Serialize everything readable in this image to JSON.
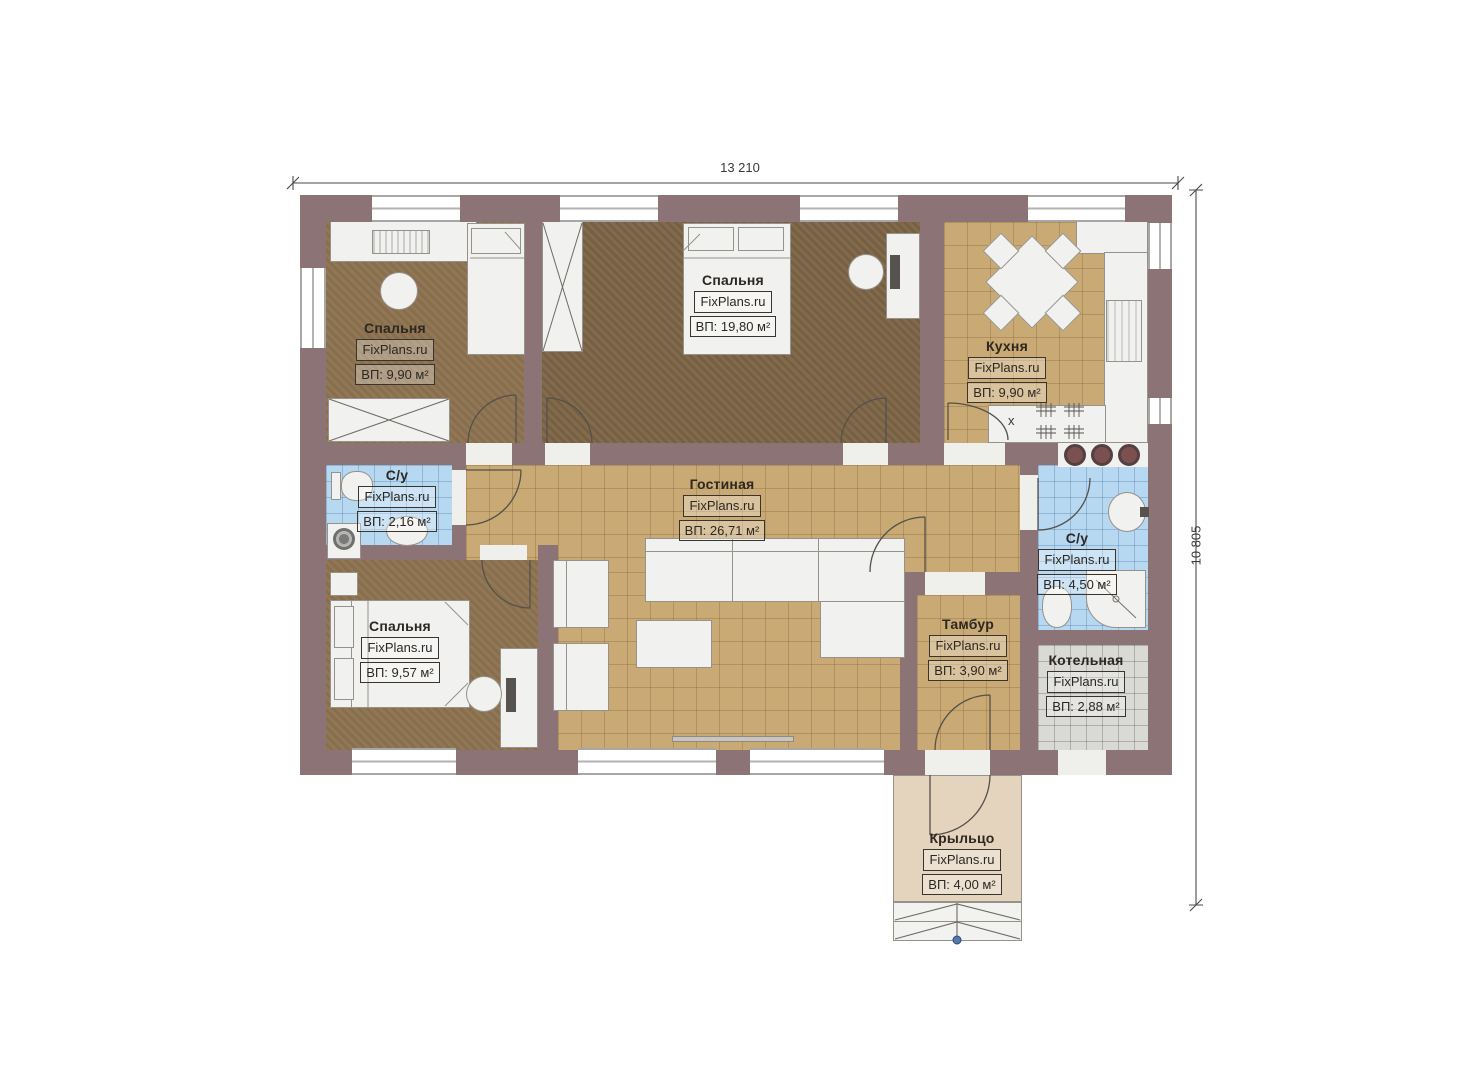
{
  "dimensions": {
    "width_label": "13 210",
    "height_label": "10 805"
  },
  "rooms": [
    {
      "id": "bedroom-top-left",
      "name": "Спальня",
      "brand": "FixPlans.ru",
      "area": "ВП: 9,90 м²"
    },
    {
      "id": "bedroom-top-center",
      "name": "Спальня",
      "brand": "FixPlans.ru",
      "area": "ВП: 19,80 м²"
    },
    {
      "id": "kitchen",
      "name": "Кухня",
      "brand": "FixPlans.ru",
      "area": "ВП: 9,90 м²"
    },
    {
      "id": "bathroom-left",
      "name": "С/у",
      "brand": "FixPlans.ru",
      "area": "ВП: 2,16 м²"
    },
    {
      "id": "living-room",
      "name": "Гостиная",
      "brand": "FixPlans.ru",
      "area": "ВП: 26,71 м²"
    },
    {
      "id": "bedroom-bottom-left",
      "name": "Спальня",
      "brand": "FixPlans.ru",
      "area": "ВП: 9,57 м²"
    },
    {
      "id": "bathroom-right",
      "name": "С/у",
      "brand": "FixPlans.ru",
      "area": "ВП: 4,50 м²"
    },
    {
      "id": "vestibule",
      "name": "Тамбур",
      "brand": "FixPlans.ru",
      "area": "ВП: 3,90 м²"
    },
    {
      "id": "boiler-room",
      "name": "Котельная",
      "brand": "FixPlans.ru",
      "area": "ВП: 2,88 м²"
    },
    {
      "id": "porch",
      "name": "Крыльцо",
      "brand": "FixPlans.ru",
      "area": "ВП: 4,00 м²"
    }
  ],
  "kitchen_marks": {
    "stove_mark": "х"
  },
  "colors": {
    "wall": "#8b7376",
    "tile_tan": "#c9a974",
    "tile_blue": "#b7d8f1",
    "tile_gray": "#d9d9d6",
    "floor_bedroom": "#8d7350",
    "floor_bedroom_dark": "#7d6546",
    "porch": "#e4d4bd",
    "step_marker_dot": "#5577aa"
  }
}
